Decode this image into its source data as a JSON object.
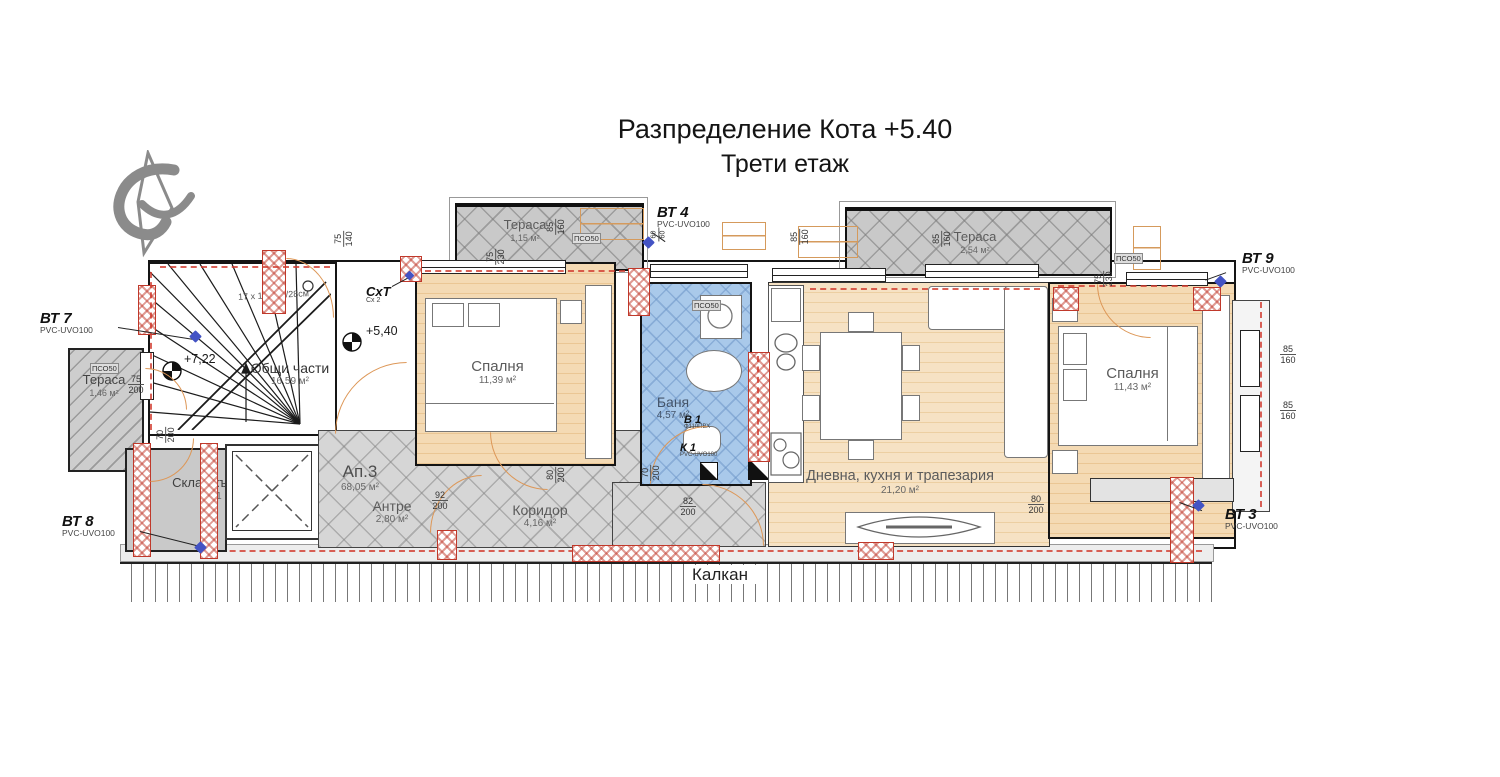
{
  "title": {
    "line1": "Разпределение  Кота +5.40",
    "line2": "Трети етаж"
  },
  "plan": {
    "rooms": {
      "terrace1": {
        "name": "Тераса",
        "area": "1,15 м²"
      },
      "terrace2": {
        "name": "Тераса",
        "area": "2,54 м²"
      },
      "terrace3": {
        "name": "Тераса",
        "area": "1,46 м²"
      },
      "bedroom1": {
        "name": "Спалня",
        "area": "11,39 м²"
      },
      "bedroom2": {
        "name": "Спалня",
        "area": "11,43 м²"
      },
      "bath": {
        "name": "Баня",
        "area": "4,57 м²"
      },
      "living": {
        "name": "Дневна, кухня и трапезария",
        "area": "21,20 м²"
      },
      "common": {
        "name": "Общи части",
        "area": "16,59 м²"
      },
      "apartment": {
        "name": "Ап.3",
        "area": "68,05 м²"
      },
      "entry": {
        "name": "Антре",
        "area": "2,80 м²"
      },
      "corridor": {
        "name": "Коридор",
        "area": "4,16 м²"
      },
      "storage": {
        "name": "Склад към ап.3",
        "area": "1,21 м²"
      }
    },
    "markers": {
      "bt7": {
        "label": "ВТ 7",
        "sub": "PVC-UVO100"
      },
      "bt8": {
        "label": "ВТ 8",
        "sub": "PVC-UVO100"
      },
      "bt4": {
        "label": "ВТ 4",
        "sub": "PVC-UVO100"
      },
      "bt9": {
        "label": "ВТ 9",
        "sub": "PVC-UVO100"
      },
      "bt3": {
        "label": "ВТ 3",
        "sub": "PVC-UVO100"
      },
      "sht": {
        "label": "СхТ",
        "sub": "Сх 2"
      },
      "v1": {
        "label": "В 1",
        "sub": "Ф110ПВХ"
      },
      "k1": {
        "label": "К 1",
        "sub": "PVC-UVO100"
      }
    },
    "elevations": {
      "upper": "+7,22",
      "current": "+5,40"
    },
    "stairs_note": "17 x 16.5см/28см",
    "kalkan_label": "Калкан",
    "pso_label": "ПСО50",
    "dims": [
      {
        "w": "75",
        "h": "140"
      },
      {
        "w": "85",
        "h": "160"
      },
      {
        "w": "75",
        "h": "230"
      },
      {
        "w": "60",
        "h": "60"
      },
      {
        "w": "85",
        "h": "160"
      },
      {
        "w": "85",
        "h": "160"
      },
      {
        "w": "75",
        "h": "230"
      },
      {
        "w": "75",
        "h": "200"
      },
      {
        "w": "70",
        "h": "200"
      },
      {
        "w": "92",
        "h": "200"
      },
      {
        "w": "80",
        "h": "200"
      },
      {
        "w": "70",
        "h": "200"
      },
      {
        "w": "82",
        "h": "200"
      },
      {
        "w": "80",
        "h": "200"
      },
      {
        "w": "85",
        "h": "160"
      },
      {
        "w": "85",
        "h": "160"
      }
    ],
    "colors": {
      "wood": "#f3d9b4",
      "tile_blue": "#a9c9ea",
      "tile_gray": "#d6d6d6",
      "terrace_gray": "#c9c9c9",
      "pier_red": "#c0392b",
      "marker_blue": "#4353c4",
      "dash_red": "#d23b2f",
      "door_orange": "#dd9757"
    }
  }
}
